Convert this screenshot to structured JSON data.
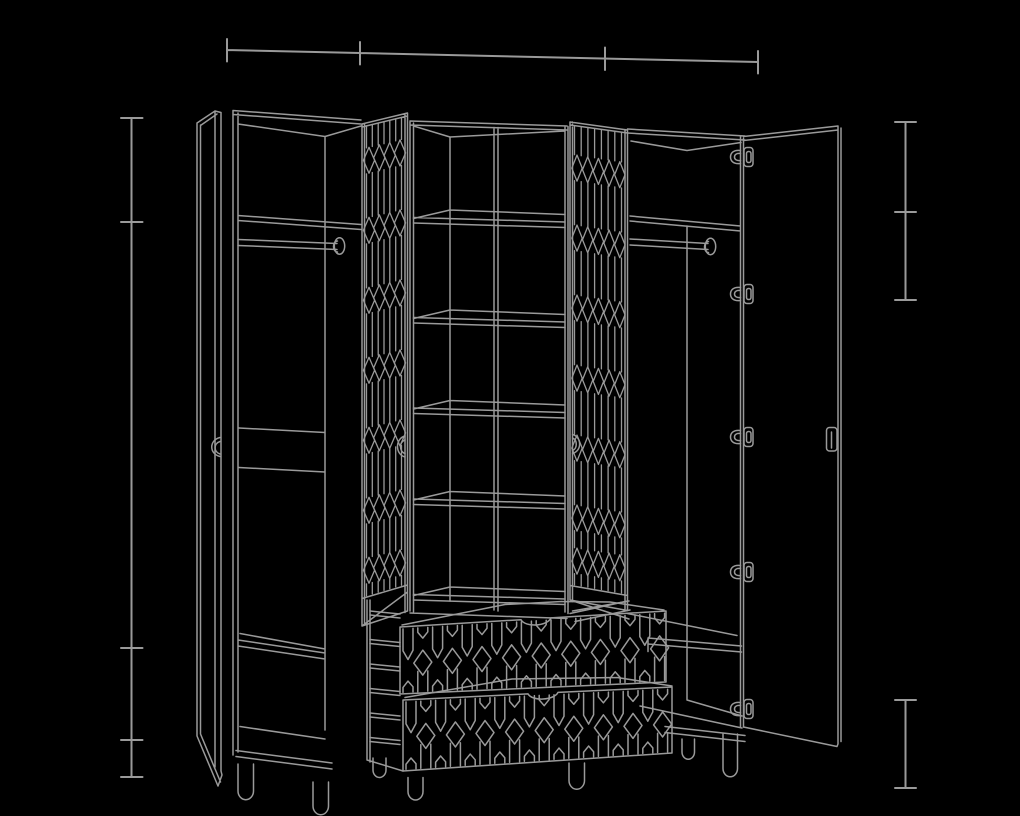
{
  "meta": {
    "title": "Wardrobe technical line drawing",
    "type": "furniture-assembly-illustration",
    "background_color": "#000000",
    "line_color": "#9a9a9a"
  },
  "drawing": {
    "subject": "Four-section wardrobe shown with doors open",
    "visible_text": [],
    "components": {
      "left_door": "open hinged door with edge handle, far left",
      "left_compartment": "hanging rail with end cap, two mid panel lines, lower shelf and bottom panel",
      "lattice_door_left": "folded door with vertical slats and diamond lattice bands",
      "center_shelf_unit": {
        "columns": 2,
        "shelf_rows": 6,
        "divider": "center vertical"
      },
      "lattice_door_right": "folded door with vertical slats and diamond lattice bands",
      "right_compartment": "hanging rail with end cap, lower shelf and bottom panel",
      "right_door": "open hinged door with five hinges and edge handle",
      "drawers": {
        "count": 2,
        "front_pattern": "elongated-hexagon honeycomb",
        "handle": "top center notch"
      },
      "hinges": 5,
      "legs": 7,
      "handles": 4
    },
    "dimension_lines": [
      {
        "name": "overall-width",
        "position": "top",
        "orientation": "horizontal",
        "tick_count": 4,
        "segments": 3
      },
      {
        "name": "overall-height",
        "position": "left",
        "orientation": "vertical",
        "tick_count": 5,
        "segments": 4
      },
      {
        "name": "upper-right-heights",
        "position": "right-upper",
        "orientation": "vertical",
        "tick_count": 3,
        "segments": 2
      },
      {
        "name": "base-height",
        "position": "right-lower",
        "orientation": "vertical",
        "tick_count": 2,
        "segments": 1
      }
    ]
  }
}
